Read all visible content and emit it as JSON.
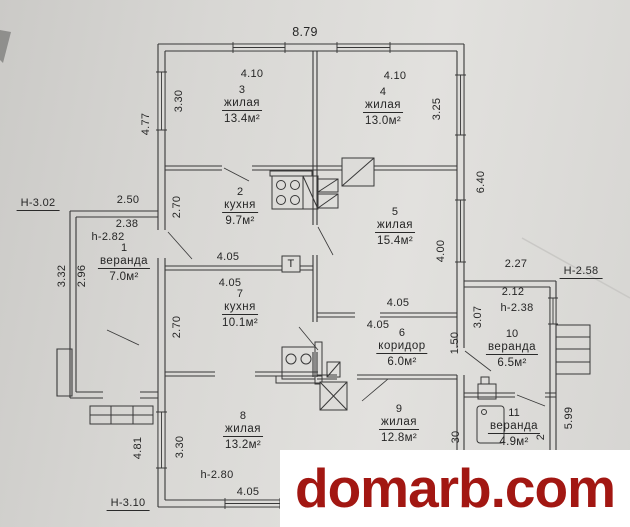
{
  "watermark": {
    "text": "domarb.com",
    "color": "#a21712",
    "background": "#ffffff"
  },
  "plan": {
    "line_color": "#383838",
    "paper_color": "#d9d8d5",
    "rooms": [
      {
        "num": "1",
        "name": "веранда",
        "area": "7.0м²",
        "x": 124,
        "y": 242
      },
      {
        "num": "2",
        "name": "кухня",
        "area": "9.7м²",
        "x": 240,
        "y": 186
      },
      {
        "num": "3",
        "name": "жилая",
        "area": "13.4м²",
        "x": 242,
        "y": 84
      },
      {
        "num": "4",
        "name": "жилая",
        "area": "13.0м²",
        "x": 383,
        "y": 86
      },
      {
        "num": "5",
        "name": "жилая",
        "area": "15.4м²",
        "x": 395,
        "y": 206
      },
      {
        "num": "6",
        "name": "коридор",
        "area": "6.0м²",
        "x": 402,
        "y": 327
      },
      {
        "num": "7",
        "name": "кухня",
        "area": "10.1м²",
        "x": 240,
        "y": 288
      },
      {
        "num": "8",
        "name": "жилая",
        "area": "13.2м²",
        "x": 243,
        "y": 410
      },
      {
        "num": "9",
        "name": "жилая",
        "area": "12.8м²",
        "x": 399,
        "y": 403
      },
      {
        "num": "10",
        "name": "веранда",
        "area": "6.5м²",
        "x": 512,
        "y": 328
      },
      {
        "num": "11",
        "name": "веранда",
        "area": "4.9м²",
        "x": 514,
        "y": 407
      }
    ],
    "dims": [
      {
        "t": "8.79",
        "x": 305,
        "y": 32,
        "big": true
      },
      {
        "t": "4.10",
        "x": 252,
        "y": 74
      },
      {
        "t": "4.10",
        "x": 395,
        "y": 76
      },
      {
        "t": "3.30",
        "x": 179,
        "y": 101,
        "v": true
      },
      {
        "t": "3.25",
        "x": 437,
        "y": 109,
        "v": true
      },
      {
        "t": "4.77",
        "x": 146,
        "y": 124,
        "v": true
      },
      {
        "t": "6.40",
        "x": 481,
        "y": 182,
        "v": true
      },
      {
        "t": "2.50",
        "x": 128,
        "y": 200
      },
      {
        "t": "Н-3.02",
        "x": 38,
        "y": 204,
        "u": true,
        "n": "height-mark"
      },
      {
        "t": "2.38",
        "x": 127,
        "y": 224
      },
      {
        "t": "h-2.82",
        "x": 108,
        "y": 237,
        "n": "height-mark"
      },
      {
        "t": "2.70",
        "x": 177,
        "y": 207,
        "v": true
      },
      {
        "t": "4.05",
        "x": 228,
        "y": 257
      },
      {
        "t": "4.05",
        "x": 230,
        "y": 283
      },
      {
        "t": "2.70",
        "x": 177,
        "y": 327,
        "v": true
      },
      {
        "t": "4.00",
        "x": 441,
        "y": 251,
        "v": true
      },
      {
        "t": "4.05",
        "x": 398,
        "y": 303
      },
      {
        "t": "4.05",
        "x": 378,
        "y": 325
      },
      {
        "t": "1.50",
        "x": 455,
        "y": 343,
        "v": true
      },
      {
        "t": "3.07",
        "x": 478,
        "y": 317,
        "v": true
      },
      {
        "t": "2.27",
        "x": 516,
        "y": 264
      },
      {
        "t": "Н-2.58",
        "x": 581,
        "y": 272,
        "u": true,
        "n": "height-mark"
      },
      {
        "t": "2.12",
        "x": 513,
        "y": 292
      },
      {
        "t": "h-2.38",
        "x": 517,
        "y": 308,
        "n": "height-mark"
      },
      {
        "t": "3.32",
        "x": 62,
        "y": 276,
        "v": true
      },
      {
        "t": "2.96",
        "x": 82,
        "y": 276,
        "v": true
      },
      {
        "t": "5.99",
        "x": 569,
        "y": 418,
        "v": true
      },
      {
        "t": "3.30",
        "x": 180,
        "y": 447,
        "v": true
      },
      {
        "t": "4.81",
        "x": 138,
        "y": 448,
        "v": true
      },
      {
        "t": "h-2.80",
        "x": 217,
        "y": 475,
        "n": "height-mark"
      },
      {
        "t": "4.05",
        "x": 248,
        "y": 492
      },
      {
        "t": "Н-3.10",
        "x": 128,
        "y": 504,
        "u": true,
        "n": "height-mark"
      },
      {
        "t": "30",
        "x": 456,
        "y": 437,
        "v": true
      },
      {
        "t": "2",
        "x": 541,
        "y": 437,
        "v": true
      },
      {
        "t": "Т",
        "x": 291,
        "y": 264,
        "n": "boiler-label"
      }
    ]
  }
}
